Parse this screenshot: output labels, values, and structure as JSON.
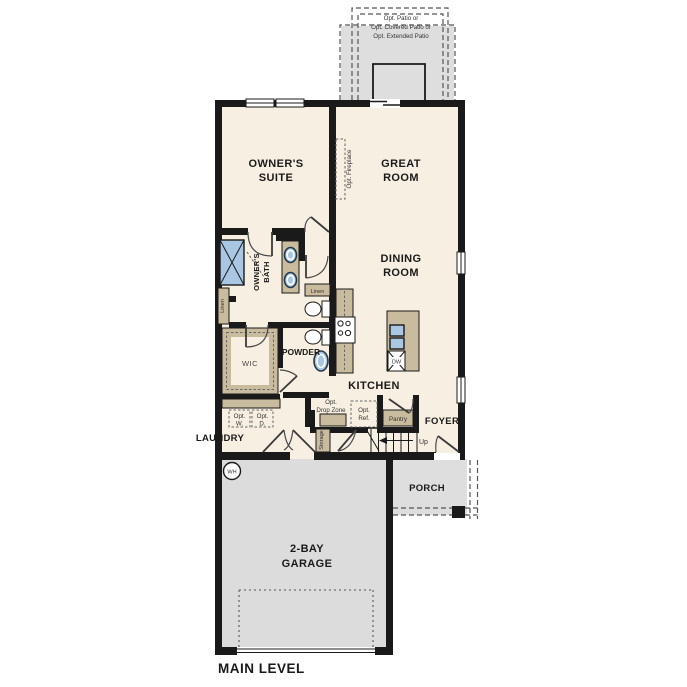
{
  "colors": {
    "wall": "#1a1a1a",
    "floor": "#f7efe1",
    "concrete": "#dcdcdc",
    "cabinet": "#c9bc9e",
    "water_fixture": "#a9c6e2"
  },
  "title": {
    "level": "MAIN LEVEL"
  },
  "patio": {
    "line1": "Opt. Patio or",
    "line2": "Opt. Covered Patio or",
    "line3": "Opt. Extended Patio"
  },
  "rooms": {
    "owners_suite": {
      "l1": "OWNER'S",
      "l2": "SUITE"
    },
    "great_room": {
      "l1": "GREAT",
      "l2": "ROOM"
    },
    "dining_room": {
      "l1": "DINING",
      "l2": "ROOM"
    },
    "owners_bath": {
      "l1": "OWNER'S",
      "l2": "BATH"
    },
    "garage": {
      "l1": "2-BAY",
      "l2": "GARAGE"
    },
    "kitchen": "KITCHEN",
    "foyer": "FOYER",
    "porch": "PORCH",
    "laundry": "LAUNDRY",
    "powder": "POWDER",
    "wic": "WIC"
  },
  "labels": {
    "fireplace": "Opt. Fireplace",
    "linen_left": "Linen",
    "linen_right": "Linen",
    "storage": "Storage",
    "pantry": "Pantry",
    "up": "Up",
    "dw": "DW",
    "wh": "WH",
    "drop_zone_l1": "Opt.",
    "drop_zone_l2": "Drop Zone",
    "ref_l1": "Opt.",
    "ref_l2": "Ref.",
    "washer_l1": "Opt.",
    "washer_l2": "W.",
    "dryer_l1": "Opt.",
    "dryer_l2": "D."
  }
}
